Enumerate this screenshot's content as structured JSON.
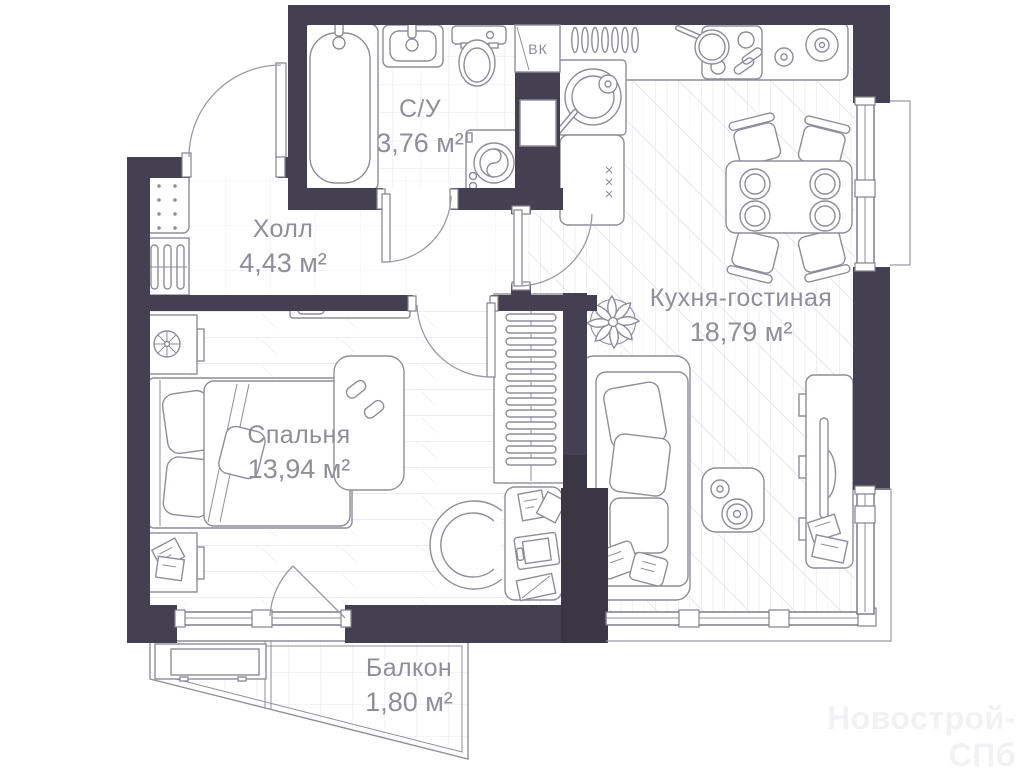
{
  "plan": {
    "watermark": "Новострой-СПб",
    "shaft_label": "ВК",
    "rooms": [
      {
        "id": "bathroom",
        "name": "С/У",
        "area": "3,76 м²"
      },
      {
        "id": "hall",
        "name": "Холл",
        "area": "4,43 м²"
      },
      {
        "id": "kitchen_living",
        "name": "Кухня-гостиная",
        "area": "18,79 м²"
      },
      {
        "id": "bedroom",
        "name": "Спальня",
        "area": "13,94 м²"
      },
      {
        "id": "balcony",
        "name": "Балкон",
        "area": "1,80 м²"
      }
    ],
    "colors": {
      "wall": "#454051",
      "wall_dark": "#3a3644",
      "furniture_line": "#8f8d9b",
      "label_text": "#8f8e99",
      "watermark_text": "#f2f2f4"
    }
  }
}
